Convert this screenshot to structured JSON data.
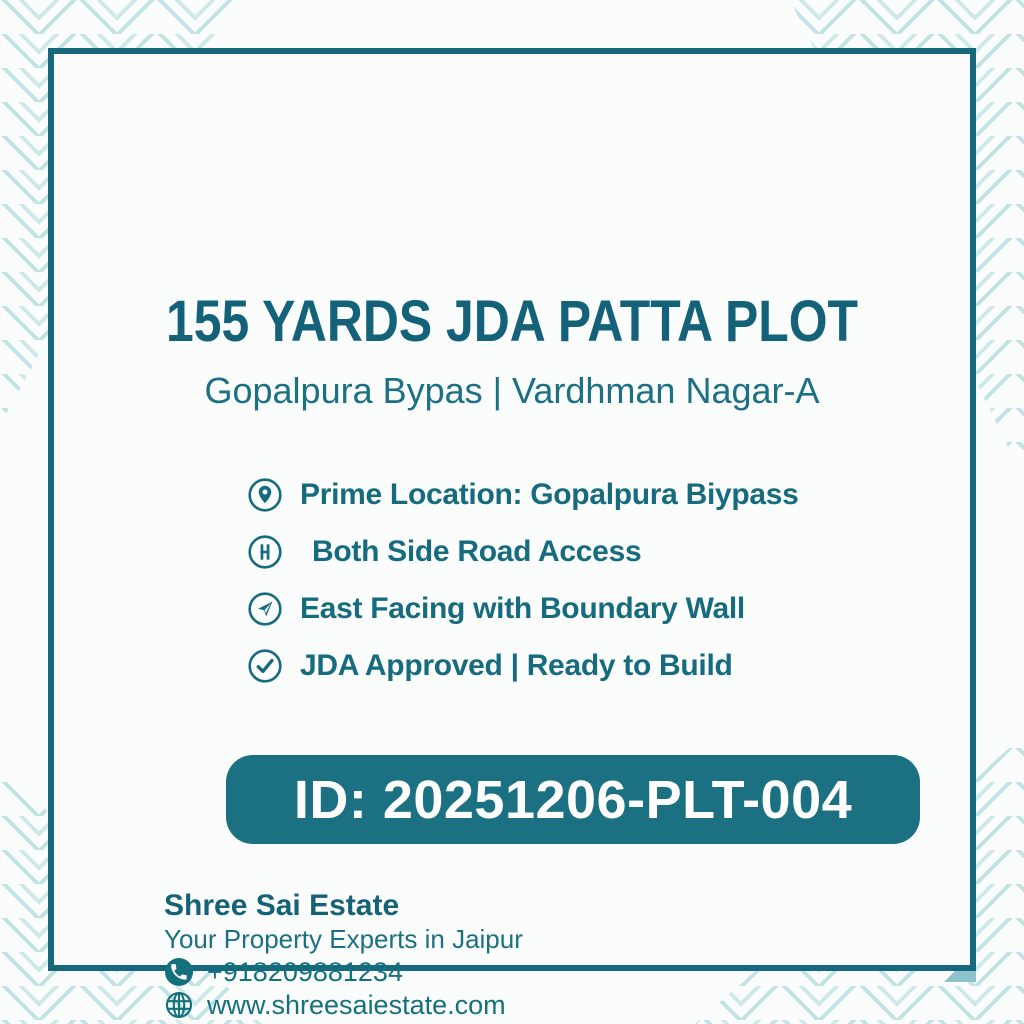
{
  "poster": {
    "title": "155 YARDS JDA PATTA PLOT",
    "subtitle": "Gopalpura Bypas | Vardhman Nagar-A",
    "features": [
      {
        "icon": "location-pin-icon",
        "text": "Prime Location: Gopalpura Biypass"
      },
      {
        "icon": "road-icon",
        "text": "Both Side Road Access"
      },
      {
        "icon": "compass-icon",
        "text": "East Facing with Boundary Wall"
      },
      {
        "icon": "check-icon",
        "text": "JDA Approved | Ready to Build"
      }
    ],
    "listing_id": "ID: 20251206-PLT-004",
    "footer": {
      "company": "Shree Sai Estate",
      "tagline": "Your Property Experts in Jaipur",
      "phone": "+918209881234",
      "phone_icon": "phone-icon",
      "website": "www.shreesaiestate.com",
      "website_icon": "globe-icon"
    },
    "colors": {
      "accent_text": "#176b7e",
      "title_text": "#14617a",
      "badge_background": "#1b7181",
      "badge_text": "#ffffff",
      "frame_border": "#16687c",
      "corner_pattern": "#c2e3e4",
      "background": "#fbfdfd"
    }
  }
}
